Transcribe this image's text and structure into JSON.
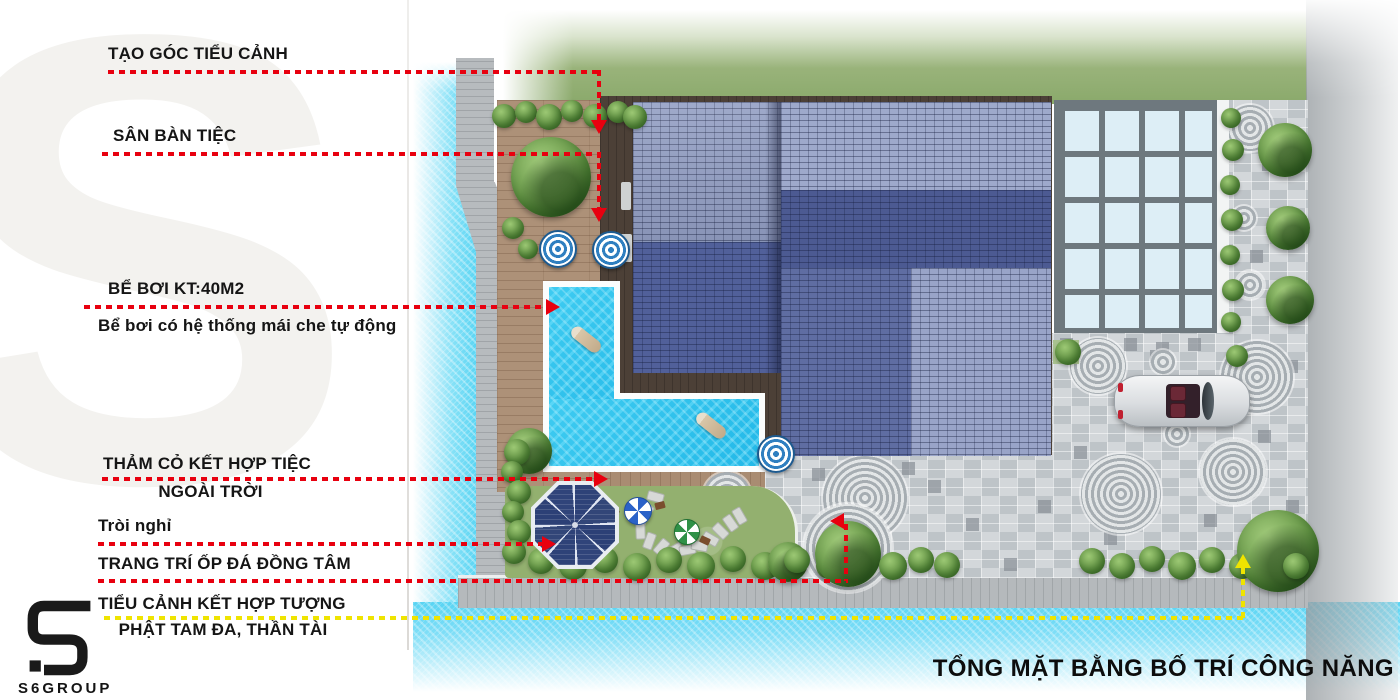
{
  "watermark_letter": "S",
  "title": "TỔNG MẶT BẰNG BỐ TRÍ CÔNG NĂNG",
  "logo": {
    "text": "S6GROUP"
  },
  "colors": {
    "annotation_red": "#e8000f",
    "annotation_yellow": "#efe400",
    "pool_water": "#2cc2ee",
    "roof_dark": "#49588b",
    "roof_light": "#9aa5c8",
    "lawn_green": "#93b06f",
    "canal_water": "#58d4f3",
    "paving_gray": "#ccd1d4",
    "glass_skylight": "#ddeef6",
    "deck_wood": "#ad9178",
    "building_base_brown": "#4c4037"
  },
  "annotations": [
    {
      "label": "TẠO GÓC TIỂU CẢNH",
      "color": "red"
    },
    {
      "label": "SÂN BÀN TIỆC",
      "color": "red"
    },
    {
      "label": "BỂ BƠI KT:40M2",
      "sublabel": "Bể bơi có hệ thống mái che tự động",
      "color": "red"
    },
    {
      "label": "THẢM CỎ KẾT HỢP TIỆC",
      "label2": "NGOÀI TRỜI",
      "color": "red"
    },
    {
      "label": "Tròi nghỉ",
      "color": "red"
    },
    {
      "label": "TRANG TRÍ ỐP ĐÁ ĐỒNG TÂM",
      "color": "red"
    },
    {
      "label": "TIỂU CẢNH KẾT HỢP TƯỢNG",
      "label2": "PHẬT TAM ĐA, THẦN TÀI",
      "color": "yellow"
    }
  ]
}
